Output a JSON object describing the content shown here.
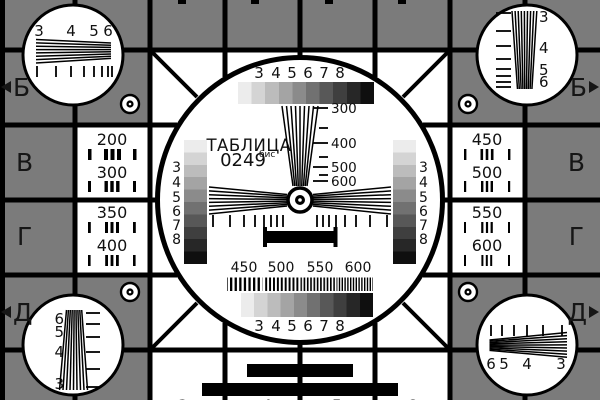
{
  "card": {
    "title": "ТАБЛИЦА",
    "number": "0249",
    "number_suffix": "бис",
    "colors": {
      "background": "#7b7b7b",
      "line": "#000000",
      "panel": "#ffffff",
      "letter": "#161616"
    },
    "grayscale_ramp": [
      "#ececec",
      "#d4d4d4",
      "#bcbcbc",
      "#a4a4a4",
      "#8b8b8b",
      "#717171",
      "#585858",
      "#3f3f3f",
      "#272727",
      "#0f0f0f"
    ],
    "edge_letters": {
      "left": [
        "Б",
        "В",
        "Г",
        "Д"
      ],
      "right": [
        "Б",
        "В",
        "Г",
        "Д"
      ]
    },
    "corner_wedges": {
      "top_left": [
        "3",
        "4",
        "5",
        "6"
      ],
      "top_right": [
        "3",
        "4",
        "5",
        "6"
      ],
      "bottom_left": [
        "6",
        "5",
        "4",
        "3"
      ],
      "bottom_right": [
        "6",
        "5",
        "4",
        "3"
      ]
    },
    "left_panel": [
      "200",
      "300",
      "350",
      "400"
    ],
    "right_panel": [
      "450",
      "500",
      "550",
      "600"
    ],
    "center": {
      "top_scale": [
        "3",
        "4",
        "5",
        "6",
        "7",
        "8"
      ],
      "bottom_scale": [
        "3",
        "4",
        "5",
        "6",
        "7",
        "8"
      ],
      "vertical_wedge_labels": [
        "300",
        "400",
        "500",
        "600"
      ],
      "frequency_labels": [
        "450",
        "500",
        "550",
        "600"
      ],
      "left_column_scale": [
        "3",
        "4",
        "5",
        "6",
        "7",
        "8"
      ],
      "right_column_scale": [
        "3",
        "4",
        "5",
        "6",
        "7",
        "8"
      ]
    },
    "bottom_partial_digits": [
      "3",
      "4",
      "5",
      "6"
    ]
  }
}
